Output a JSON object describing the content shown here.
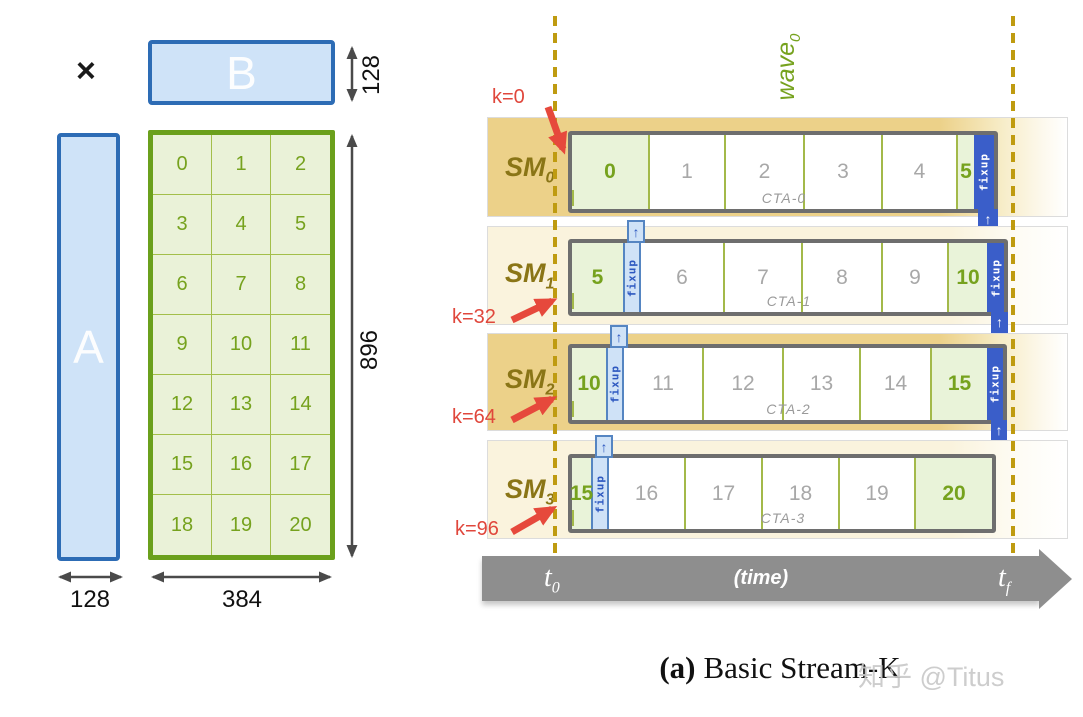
{
  "matrix_panel": {
    "times_symbol": "×",
    "matrix_b": {
      "label": "B",
      "height_dim": "128"
    },
    "matrix_a": {
      "label": "A",
      "width_dim": "128"
    },
    "grid": {
      "height_dim": "896",
      "width_dim": "384",
      "tiles": [
        "0",
        "1",
        "2",
        "3",
        "4",
        "5",
        "6",
        "7",
        "8",
        "9",
        "10",
        "11",
        "12",
        "13",
        "14",
        "15",
        "16",
        "17",
        "18",
        "19",
        "20"
      ]
    }
  },
  "timeline_panel": {
    "wave_label": {
      "base": "wave",
      "sub": "0"
    },
    "fixup_label": "fixup",
    "up_arrow_glyph": "↑",
    "sm_rows": [
      {
        "label_base": "SM",
        "label_sub": "0",
        "k_label": "k=0",
        "cta_label": "CTA-0",
        "leading_fixup": false,
        "trailing_fixup": {
          "w": 20
        },
        "tiles": [
          {
            "label": "0",
            "kind": "green",
            "w": 76
          },
          {
            "label": "1",
            "kind": "plain",
            "w": 76
          },
          {
            "label": "2",
            "kind": "plain",
            "w": 79
          },
          {
            "label": "3",
            "kind": "plain",
            "w": 78
          },
          {
            "label": "4",
            "kind": "plain",
            "w": 75
          },
          {
            "label": "5",
            "kind": "green",
            "w": 18
          }
        ]
      },
      {
        "label_base": "SM",
        "label_sub": "1",
        "k_label": "k=32",
        "cta_label": "CTA-1",
        "leading_fixup": true,
        "trailing_fixup": {
          "w": 17
        },
        "tiles": [
          {
            "label": "5",
            "kind": "green",
            "w": 51
          },
          {
            "label": "6",
            "kind": "plain",
            "w": 82
          },
          {
            "label": "7",
            "kind": "plain",
            "w": 78
          },
          {
            "label": "8",
            "kind": "plain",
            "w": 80
          },
          {
            "label": "9",
            "kind": "plain",
            "w": 66
          },
          {
            "label": "10",
            "kind": "green",
            "w": 40
          }
        ]
      },
      {
        "label_base": "SM",
        "label_sub": "2",
        "k_label": "k=64",
        "cta_label": "CTA-2",
        "leading_fixup": true,
        "trailing_fixup": {
          "w": 16
        },
        "tiles": [
          {
            "label": "10",
            "kind": "green",
            "w": 34
          },
          {
            "label": "11",
            "kind": "plain",
            "w": 78
          },
          {
            "label": "12",
            "kind": "plain",
            "w": 80
          },
          {
            "label": "13",
            "kind": "plain",
            "w": 77
          },
          {
            "label": "14",
            "kind": "plain",
            "w": 71
          },
          {
            "label": "15",
            "kind": "green",
            "w": 57
          }
        ]
      },
      {
        "label_base": "SM",
        "label_sub": "3",
        "k_label": "k=96",
        "cta_label": "CTA-3",
        "leading_fixup": true,
        "trailing_fixup": null,
        "tiles": [
          {
            "label": "15",
            "kind": "green",
            "w": 19
          },
          {
            "label": "16",
            "kind": "plain",
            "w": 75
          },
          {
            "label": "17",
            "kind": "plain",
            "w": 77
          },
          {
            "label": "18",
            "kind": "plain",
            "w": 77
          },
          {
            "label": "19",
            "kind": "plain",
            "w": 76
          },
          {
            "label": "20",
            "kind": "green",
            "w": 78
          }
        ]
      }
    ],
    "time_axis": {
      "start_base": "t",
      "start_sub": "0",
      "mid_label": "(time)",
      "end_base": "t",
      "end_sub": "f"
    }
  },
  "caption": {
    "index": "(a)",
    "title": "Basic Stream-K"
  },
  "watermark": "知乎 @Titus",
  "colors": {
    "tile_green_fill": "#e9f3d9",
    "tile_green_text": "#76a21e",
    "tile_plain_text": "#a8a8a8",
    "band_tan": "#ecd189",
    "band_cream": "#faf3dd",
    "sm_label": "#8a7516",
    "fixup_dark_blue": "#3a5ec9",
    "fixup_light_blue": "#cfe2f7",
    "fixup_border_blue": "#5585c2",
    "dashed_gold": "#bf9b10",
    "k_red": "#e0473c",
    "matrix_border_blue": "#2d6cb5",
    "matrix_fill_blue": "#cfe3f8",
    "grid_border_green": "#6ba01c",
    "time_gray": "#8e8e8e"
  }
}
